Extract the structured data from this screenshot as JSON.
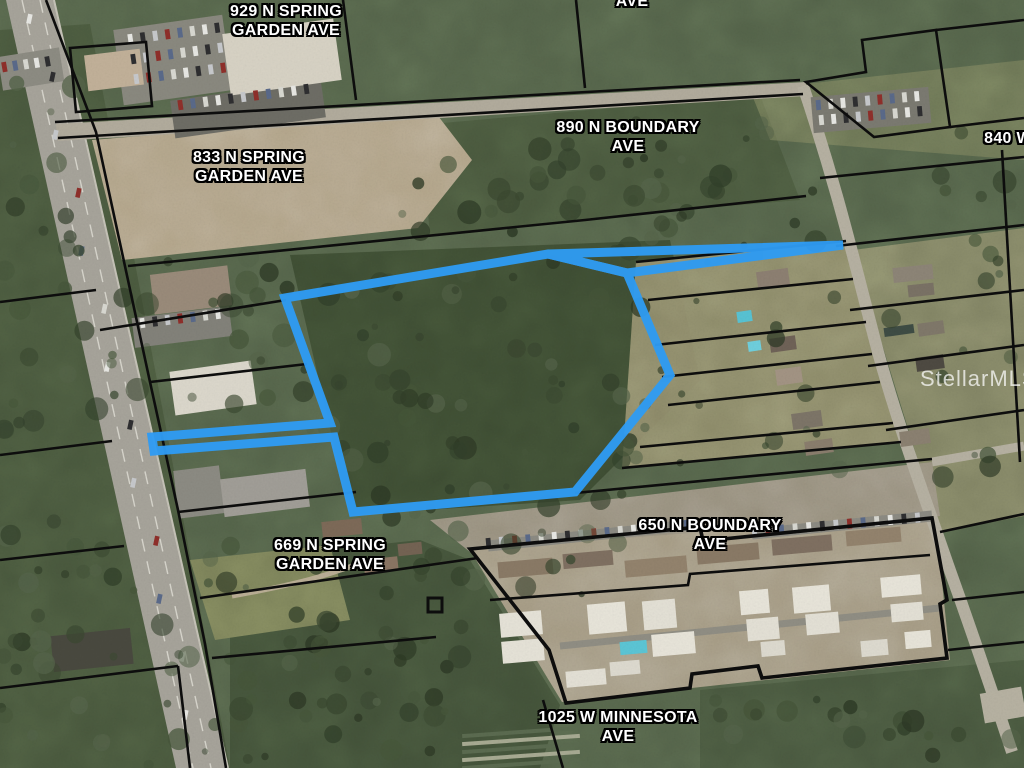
{
  "map": {
    "description": "Aerial parcel map with highlighted property boundary",
    "watermark": "StellarMLS",
    "colors": {
      "highlight": "#2f9bf2",
      "parcel_line": "#0d0d0d",
      "label_text": "#ffffff"
    },
    "labels": [
      {
        "id": "929-n-spring-garden-ave",
        "lines": [
          "929 N SPRING",
          "GARDEN AVE"
        ],
        "x": 286,
        "y": 2
      },
      {
        "id": "ave-top",
        "lines": [
          "AVE"
        ],
        "x": 632,
        "y": -8
      },
      {
        "id": "890-n-boundary-ave",
        "lines": [
          "890 N BOUNDARY",
          "AVE"
        ],
        "x": 628,
        "y": 118
      },
      {
        "id": "840-w",
        "lines": [
          "840 W"
        ],
        "x": 1008,
        "y": 129
      },
      {
        "id": "833-n-spring-garden-ave",
        "lines": [
          "833 N SPRING",
          "GARDEN AVE"
        ],
        "x": 249,
        "y": 148
      },
      {
        "id": "669-n-spring-garden-ave",
        "lines": [
          "669 N SPRING",
          "GARDEN AVE"
        ],
        "x": 330,
        "y": 536
      },
      {
        "id": "650-n-boundary-ave",
        "lines": [
          "650 N BOUNDARY",
          "AVE"
        ],
        "x": 710,
        "y": 516
      },
      {
        "id": "1025-w-minnesota-ave",
        "lines": [
          "1025 W MINNESOTA",
          "AVE"
        ],
        "x": 618,
        "y": 708
      }
    ]
  }
}
